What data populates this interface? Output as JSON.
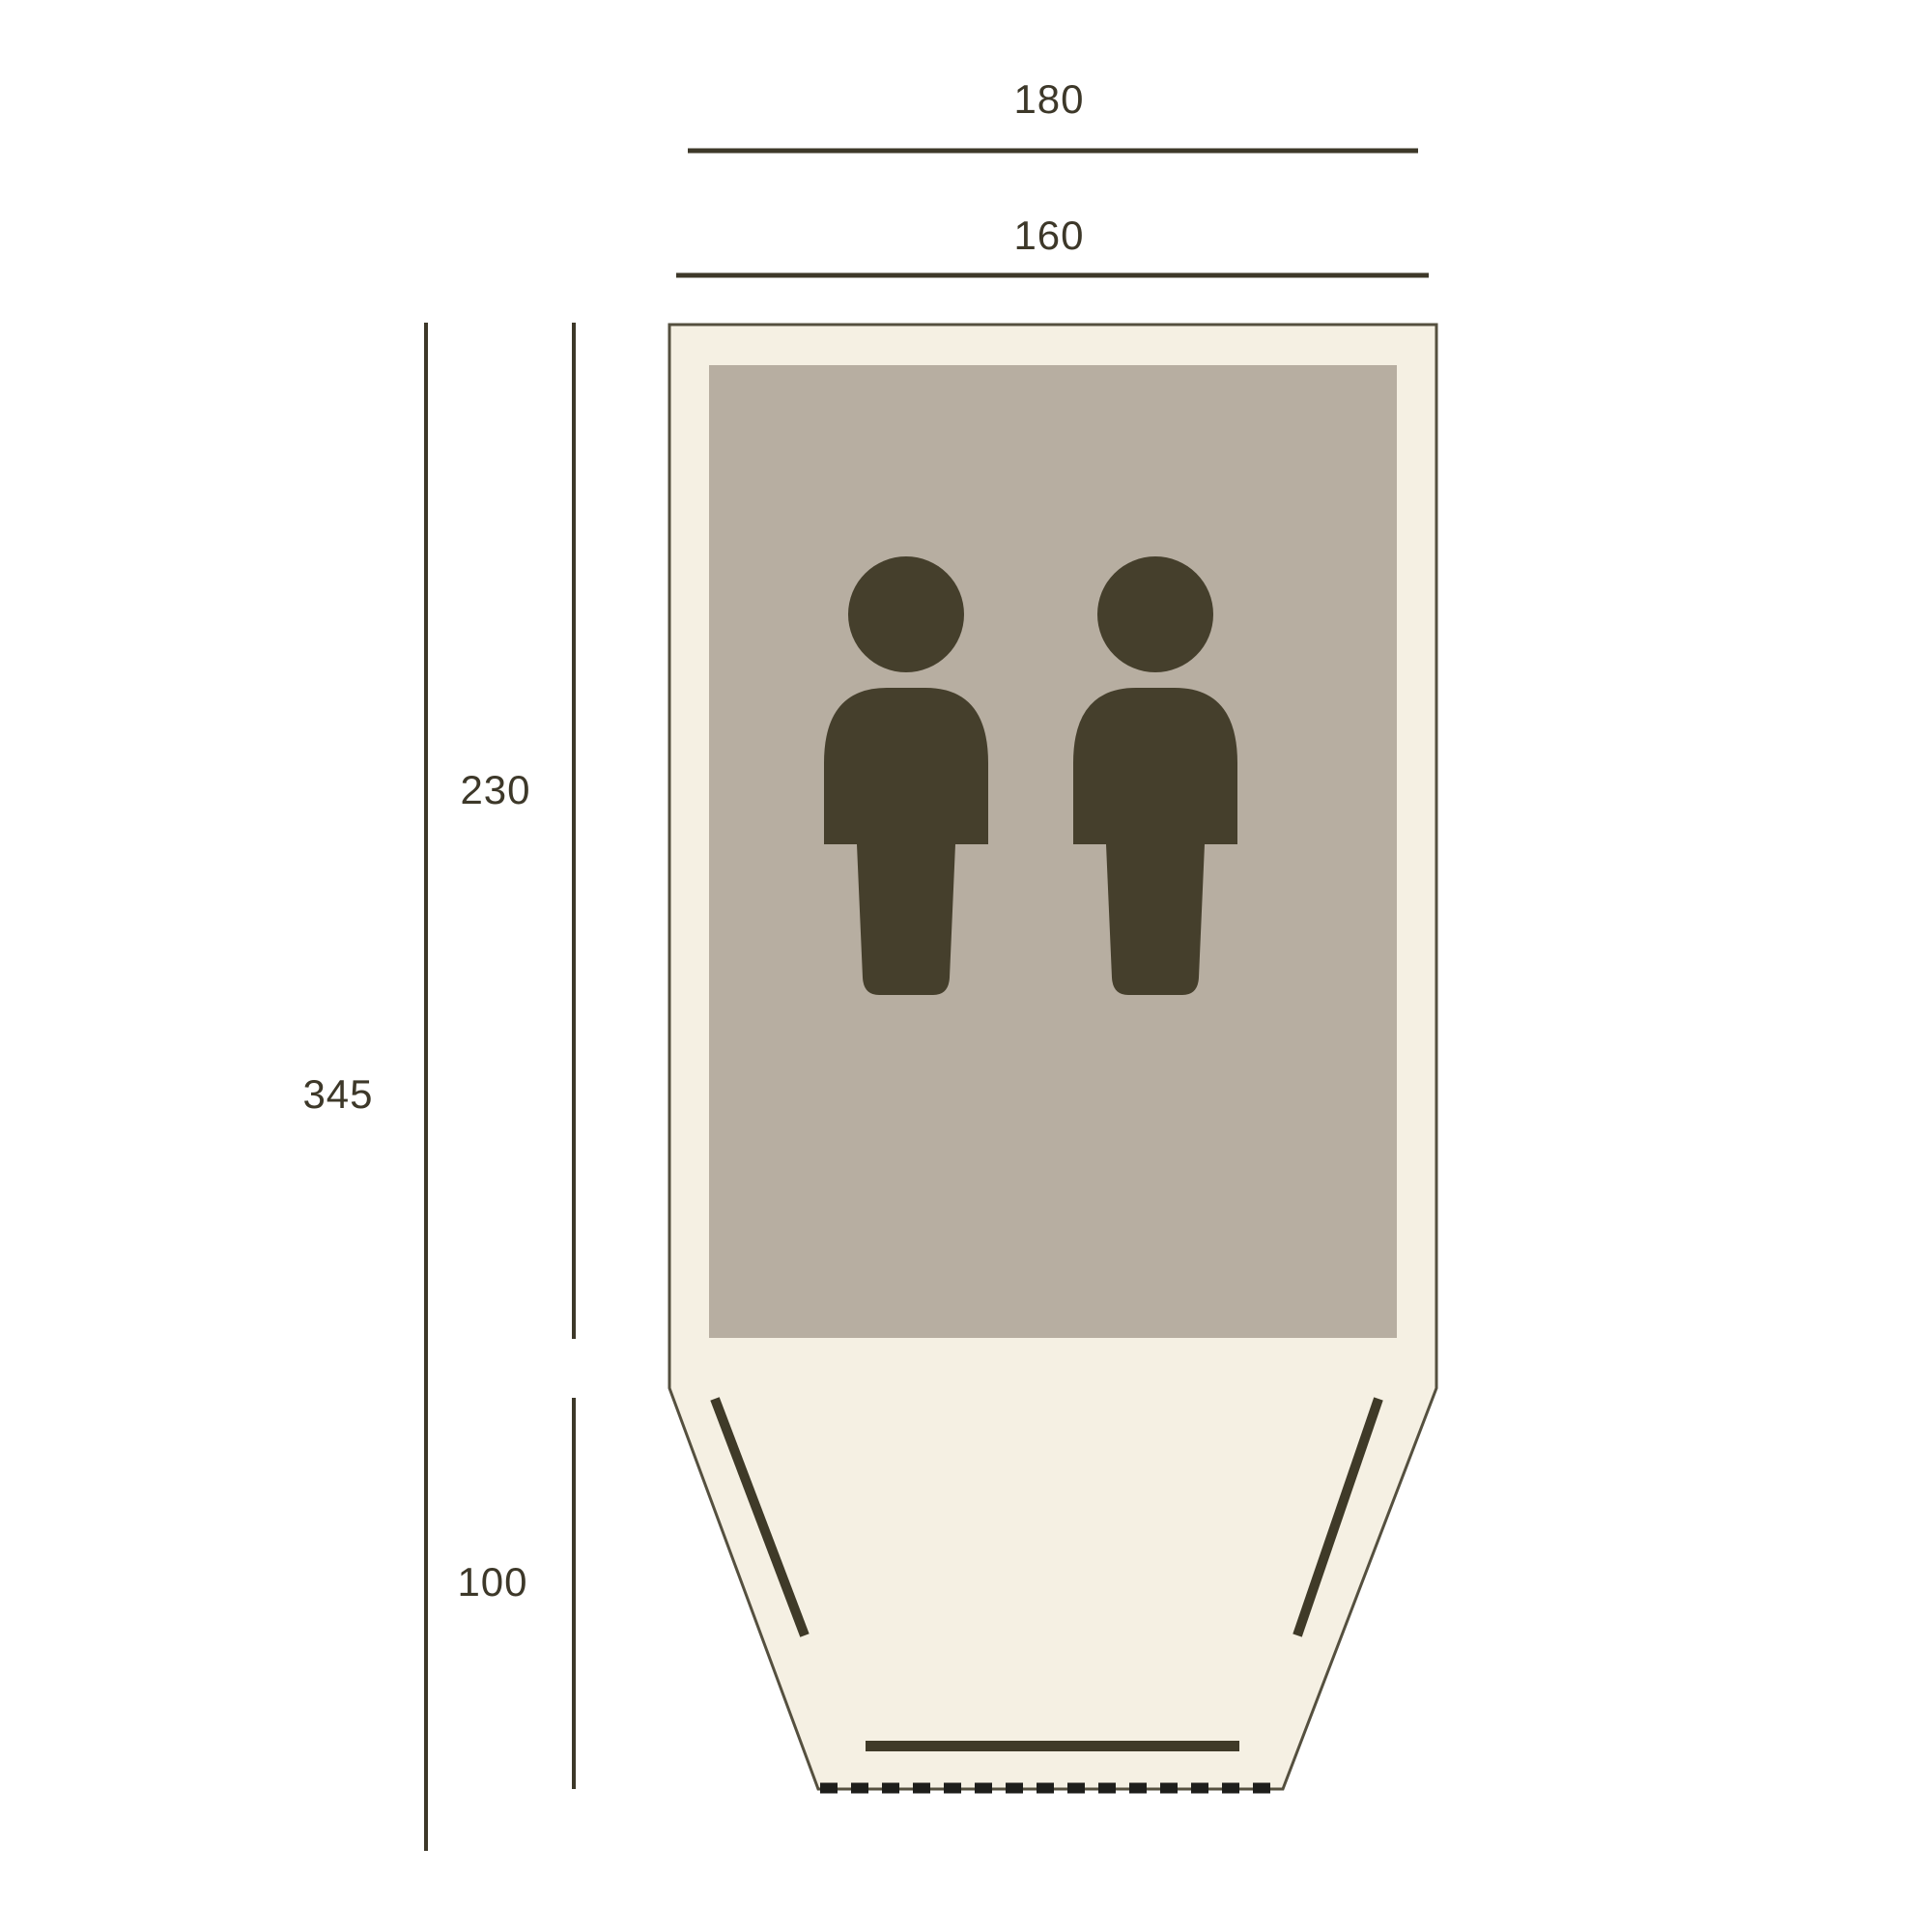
{
  "diagram": {
    "title": "tent-floorplan-dimensions",
    "labels": {
      "top_width": "180",
      "inner_width": "160",
      "inner_length": "230",
      "total_length": "345",
      "porch_length": "100"
    },
    "person_icon_count": "2",
    "colors": {
      "background": "#ffffff",
      "tent_fill": "#f5f0e3",
      "tent_outline": "#55503f",
      "mat_fill": "#b7aea1",
      "figure": "#453f2c",
      "feature": "#3f3a28",
      "dimension": "#3d3829",
      "zipper": "#1e1e1b"
    }
  }
}
